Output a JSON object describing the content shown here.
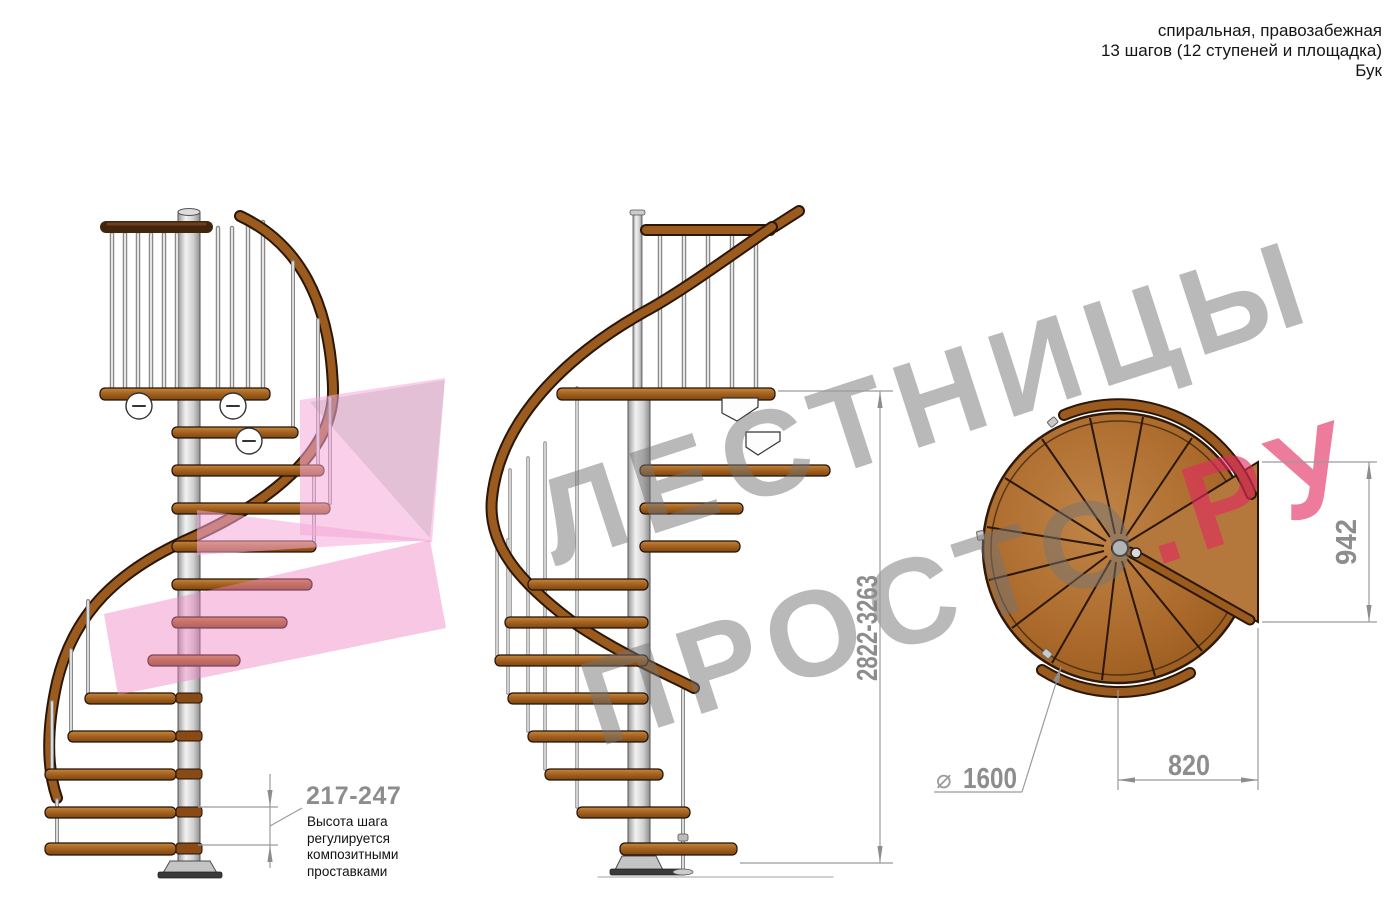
{
  "header": {
    "lines": [
      "спиральная, правозабежная",
      "13 шагов (12 ступеней и площадка)",
      "Бук"
    ]
  },
  "watermark": {
    "word1": "ЛЕСТНИЦЫ",
    "word2": "ПРОСТО",
    "word2_suffix": ".РУ",
    "gray_color": "#737373",
    "pink_color": "#e02a60"
  },
  "dimensions": {
    "total_height": "2822-3263",
    "plan_height": "942",
    "plan_width": "820",
    "diameter_symbol": "⌀",
    "diameter_value": "1600",
    "step_height": "217-247",
    "note_lines": [
      "Высота шага",
      "регулируется",
      "композитными",
      "проставками"
    ]
  },
  "colors": {
    "wood": "#ab6a2b",
    "wood_dark_line": "#2b1708",
    "rail_brown": "#9b5a1e",
    "top_rail_dark": "#42250c",
    "pole_gray": "#e8e8e8",
    "dimension_gray": "#9b9b9b",
    "arrow_pink": "#f3a8d6"
  }
}
